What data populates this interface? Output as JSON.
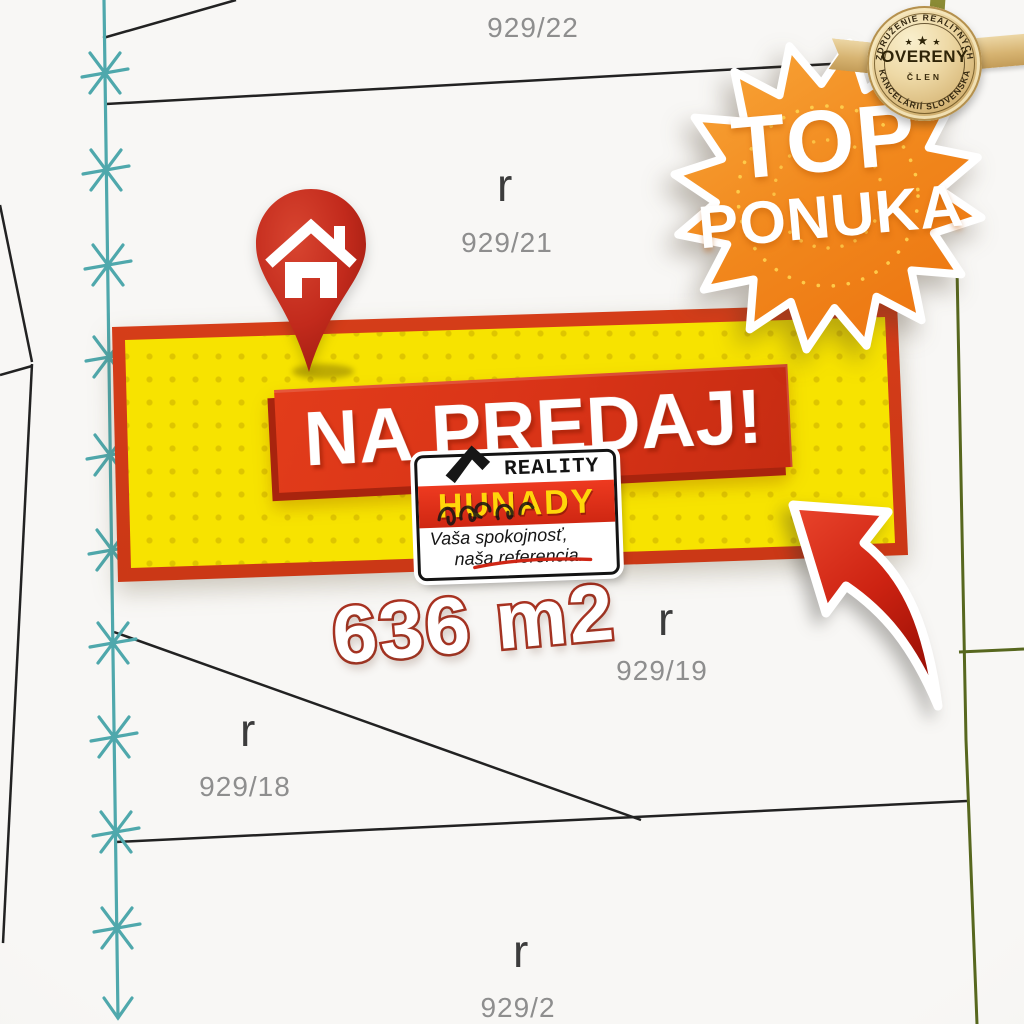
{
  "map": {
    "parcels": [
      {
        "label": "929/22",
        "marker": ""
      },
      {
        "label": "929/21",
        "marker": "r"
      },
      {
        "label": "929/18",
        "marker": "r"
      },
      {
        "label": "929/19",
        "marker": "r"
      },
      {
        "label": "929/2",
        "marker": "r"
      }
    ],
    "colors": {
      "boundary_black": "#222222",
      "surveyed_teal": "#4fa8ac",
      "boundary_green": "#57671e",
      "label_gray": "#8e8e8e"
    }
  },
  "promo": {
    "sale_banner": {
      "title": "NA PREDAJ!",
      "panel_yellow": "#f7e300",
      "border_red": "#cf3a17",
      "title_box_red": "#d83317"
    },
    "area_label": {
      "text": "636 m2",
      "outline_red": "#a93322"
    },
    "top_offer_burst": {
      "line1": "TOP",
      "line2": "PONUKA",
      "orange": "#f08a1d"
    },
    "pin": {
      "icon": "house-icon",
      "red": "#c0271a"
    },
    "arrow": {
      "icon": "curved-arrow-icon",
      "red": "#c81f10"
    }
  },
  "badge": {
    "arc_top": "ZDRUŽENIE REALITNÝCH",
    "arc_bottom": "KANCELÁRIÍ SLOVENSKA",
    "title": "OVERENÝ",
    "subtitle": "ČLEN",
    "star": "★",
    "gold": "#d9ba7c"
  },
  "agency": {
    "name": "HUNADY",
    "category": "REALITY",
    "tagline_line1": "Vaša spokojnosť,",
    "tagline_line2": "naša referencia."
  }
}
